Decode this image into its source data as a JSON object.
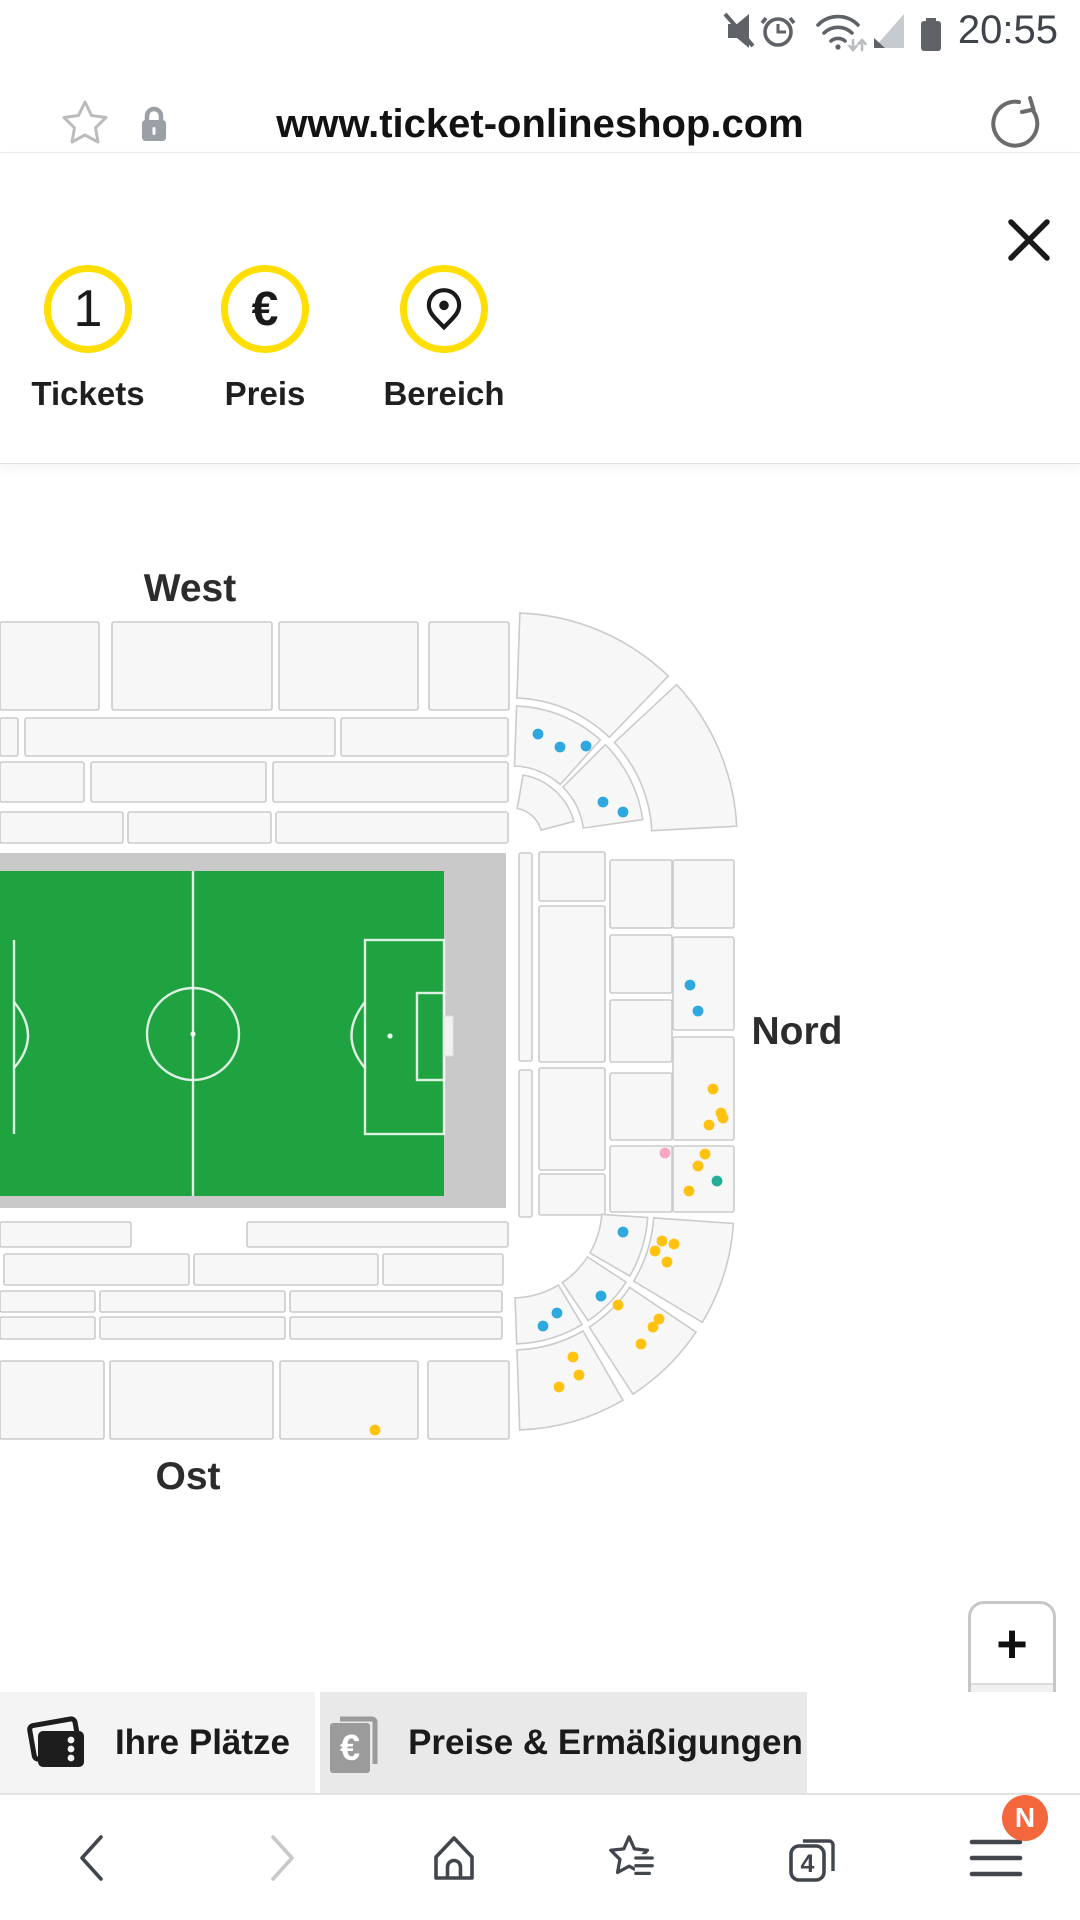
{
  "theme": {
    "accent_yellow": "#FFDE00",
    "badge_orange": "#F4673D",
    "pitch_green": "#1FA240",
    "track_gray": "#C9C9C9",
    "stand_fill": "#F7F7F7",
    "stand_stroke": "#CBCBCB"
  },
  "status_bar": {
    "time": "20:55",
    "icons": [
      "muted-icon",
      "alarm-icon",
      "wifi-icon",
      "signal-icon",
      "battery-icon"
    ]
  },
  "address_bar": {
    "url": "www.ticket-onlineshop.com"
  },
  "steps_panel": {
    "steps": [
      {
        "id": "tickets",
        "badge": "1",
        "label": "Tickets"
      },
      {
        "id": "preis",
        "symbol": "€",
        "label": "Preis"
      },
      {
        "id": "bereich",
        "icon": "location-pin-icon",
        "label": "Bereich"
      }
    ]
  },
  "map": {
    "labels": {
      "west": "West",
      "nord": "Nord",
      "ost": "Ost"
    },
    "dot_colors": {
      "blue": "#2FA8E0",
      "yellow": "#FFC20E",
      "pink": "#F7A6C5",
      "teal": "#23AF97"
    },
    "seat_dots": [
      {
        "x": 538,
        "y": 734,
        "c": "blue"
      },
      {
        "x": 560,
        "y": 747,
        "c": "blue"
      },
      {
        "x": 586,
        "y": 746,
        "c": "blue"
      },
      {
        "x": 603,
        "y": 802,
        "c": "blue"
      },
      {
        "x": 623,
        "y": 812,
        "c": "blue"
      },
      {
        "x": 690,
        "y": 985,
        "c": "blue"
      },
      {
        "x": 698,
        "y": 1011,
        "c": "blue"
      },
      {
        "x": 713,
        "y": 1089,
        "c": "yellow"
      },
      {
        "x": 721,
        "y": 1113,
        "c": "yellow"
      },
      {
        "x": 723,
        "y": 1118,
        "c": "yellow"
      },
      {
        "x": 709,
        "y": 1125,
        "c": "yellow"
      },
      {
        "x": 665,
        "y": 1153,
        "c": "pink"
      },
      {
        "x": 705,
        "y": 1154,
        "c": "yellow"
      },
      {
        "x": 698,
        "y": 1166,
        "c": "yellow"
      },
      {
        "x": 717,
        "y": 1181,
        "c": "teal"
      },
      {
        "x": 689,
        "y": 1191,
        "c": "yellow"
      },
      {
        "x": 623,
        "y": 1232,
        "c": "blue"
      },
      {
        "x": 662,
        "y": 1241,
        "c": "yellow"
      },
      {
        "x": 674,
        "y": 1244,
        "c": "yellow"
      },
      {
        "x": 655,
        "y": 1251,
        "c": "yellow"
      },
      {
        "x": 667,
        "y": 1262,
        "c": "yellow"
      },
      {
        "x": 601,
        "y": 1296,
        "c": "blue"
      },
      {
        "x": 618,
        "y": 1305,
        "c": "yellow"
      },
      {
        "x": 557,
        "y": 1313,
        "c": "blue"
      },
      {
        "x": 543,
        "y": 1326,
        "c": "blue"
      },
      {
        "x": 659,
        "y": 1319,
        "c": "yellow"
      },
      {
        "x": 653,
        "y": 1327,
        "c": "yellow"
      },
      {
        "x": 641,
        "y": 1344,
        "c": "yellow"
      },
      {
        "x": 573,
        "y": 1357,
        "c": "yellow"
      },
      {
        "x": 579,
        "y": 1375,
        "c": "yellow"
      },
      {
        "x": 559,
        "y": 1387,
        "c": "yellow"
      },
      {
        "x": 375,
        "y": 1430,
        "c": "yellow"
      }
    ]
  },
  "zoom_control": {
    "zoom_in": "+",
    "zoom_out": "−"
  },
  "tab_bar": {
    "tabs": [
      {
        "label": "Ihre Plätze",
        "icon": "tickets-icon"
      },
      {
        "label": "Preise & Ermäßigungen",
        "icon": "euro-booklet-icon",
        "icon_symbol": "€"
      }
    ]
  },
  "nav_bar": {
    "tab_count": "4",
    "badge": "N"
  }
}
